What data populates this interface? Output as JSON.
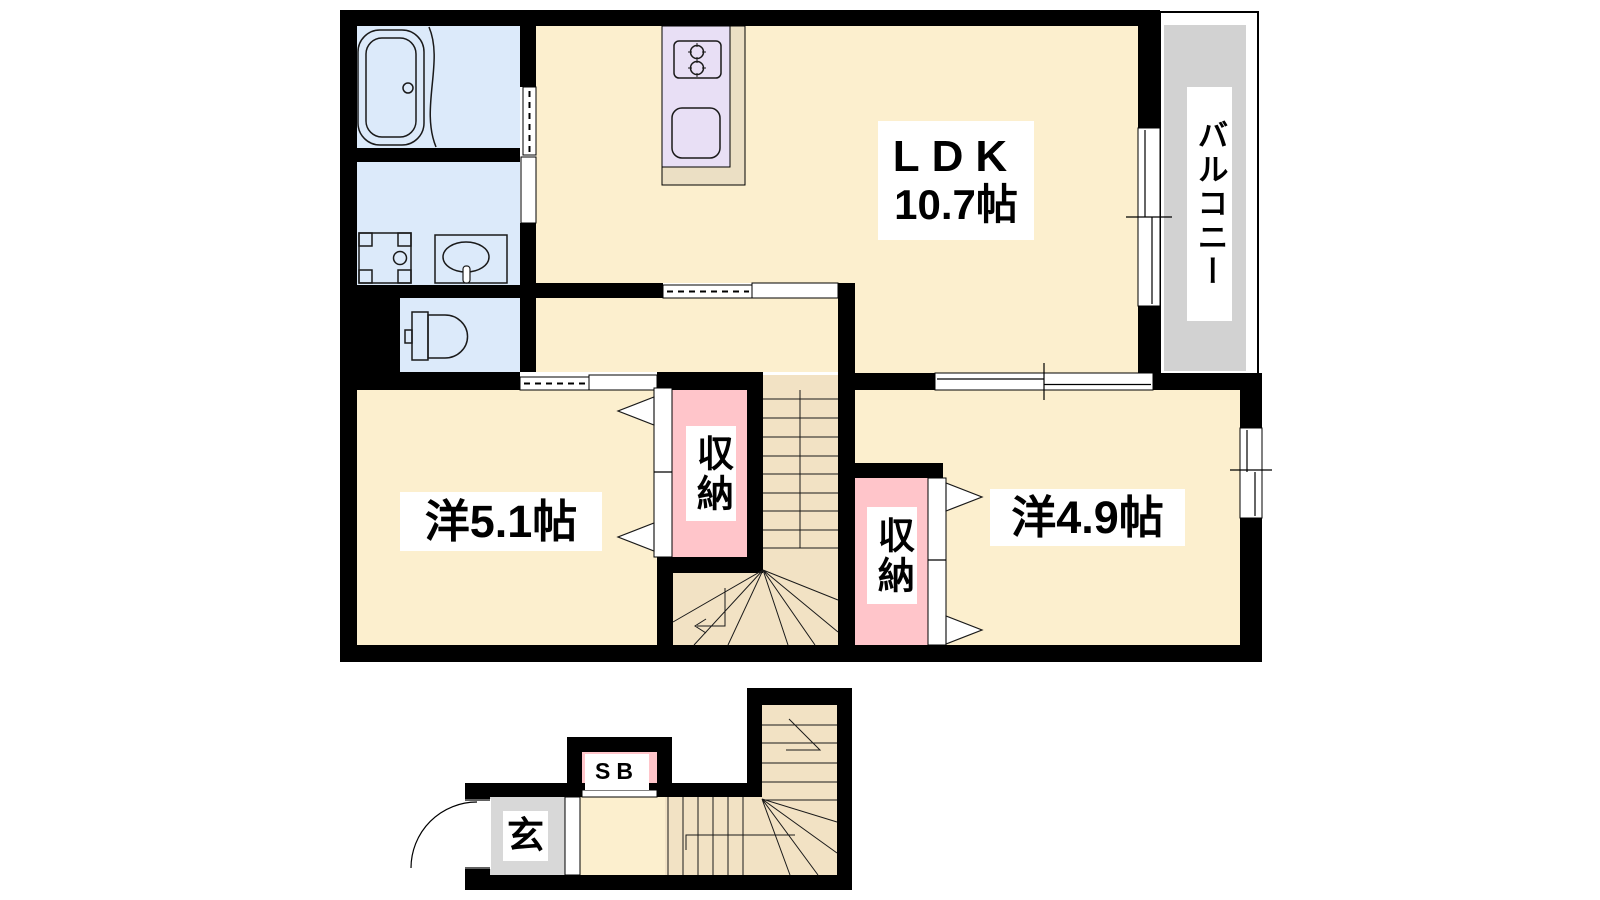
{
  "floor_plan": {
    "labels": {
      "ldk_line1": "LDK",
      "ldk_line2": "10.7帖",
      "west_room_5_1": "洋5.1帖",
      "west_room_4_9": "洋4.9帖",
      "closet_upper": "収納",
      "closet_lower": "収納",
      "balcony": "バルコニー",
      "entrance": "玄",
      "shoe_box": "SB"
    },
    "colors": {
      "wall": "#000000",
      "room_floor": "#fcefce",
      "wet_area": "#dceafa",
      "kitchen_counter": "#e8dff5",
      "kitchen_base": "#ebdfc4",
      "closet": "#ffc5ca",
      "stairs": "#f2e2c4",
      "balcony_floor": "#d2d2d2",
      "entrance_floor": "#d8d8d8",
      "label_bg": "#ffffff"
    }
  }
}
